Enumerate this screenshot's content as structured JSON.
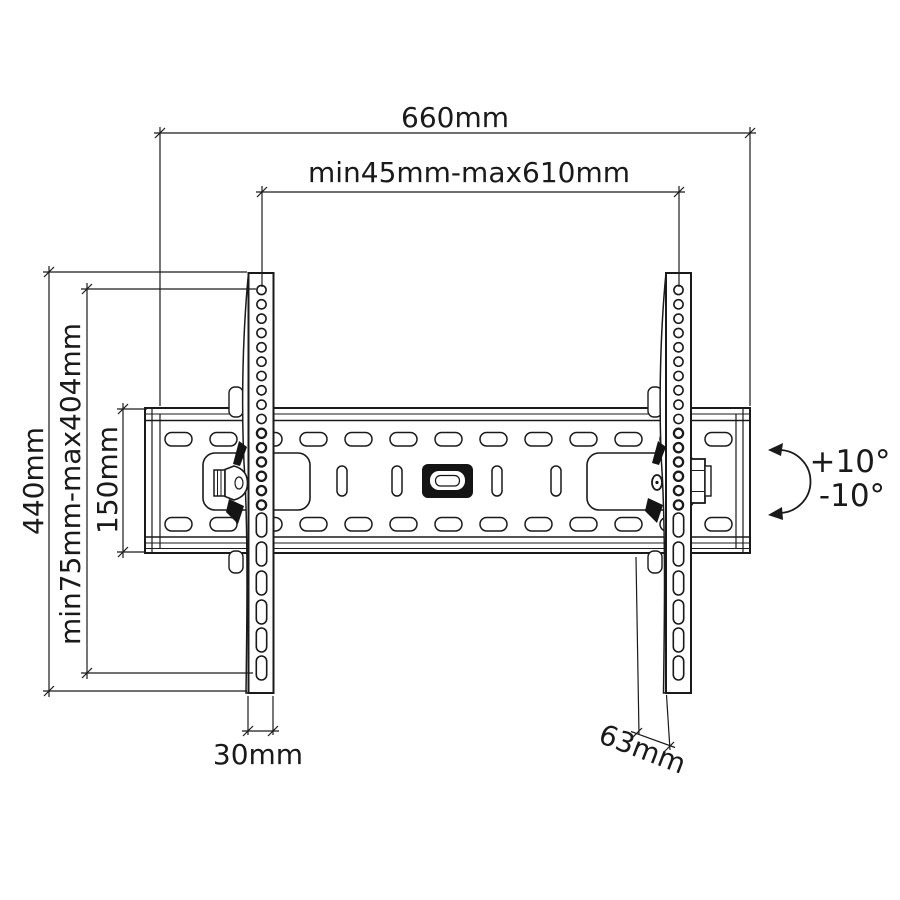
{
  "diagram": {
    "type": "technical-drawing",
    "subject": "tilting TV wall mount bracket, front view with dimensions",
    "background_color": "#ffffff",
    "line_color": "#1a1a1a",
    "labels": {
      "total_width": "660mm",
      "mount_width_range": "min45mm-max610mm",
      "bracket_height": "440mm",
      "vesa_height_range": "min75mm-max404mm",
      "wall_plate_height": "150mm",
      "bracket_foot_width": "30mm",
      "bracket_depth": "63mm",
      "tilt_up": "+10°",
      "tilt_down": "-10°"
    }
  }
}
